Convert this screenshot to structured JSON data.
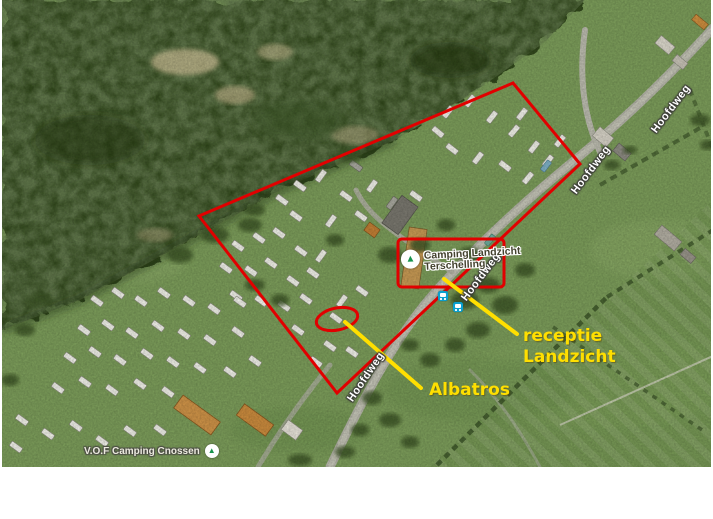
{
  "map": {
    "road_labels": [
      "Hoofdweg",
      "Hoofdweg",
      "Hoofdweg",
      "Hoofdweg"
    ],
    "poi": {
      "landzicht": {
        "name_line1": "Camping Landzicht",
        "name_line2": "Terschelling",
        "icon_glyph": "▲"
      },
      "cnossen": {
        "name": "V.O.F Camping Cnossen",
        "icon_glyph": "▲"
      }
    },
    "annotations": {
      "receptie_line1": "receptie",
      "receptie_line2": "Landzicht",
      "albatros": "Albatros"
    },
    "colors": {
      "boundary_red": "#e10000",
      "annotation_yellow": "#ffdf00",
      "poi_icon_green": "#17934d",
      "road_label_white": "#ffffff"
    }
  }
}
